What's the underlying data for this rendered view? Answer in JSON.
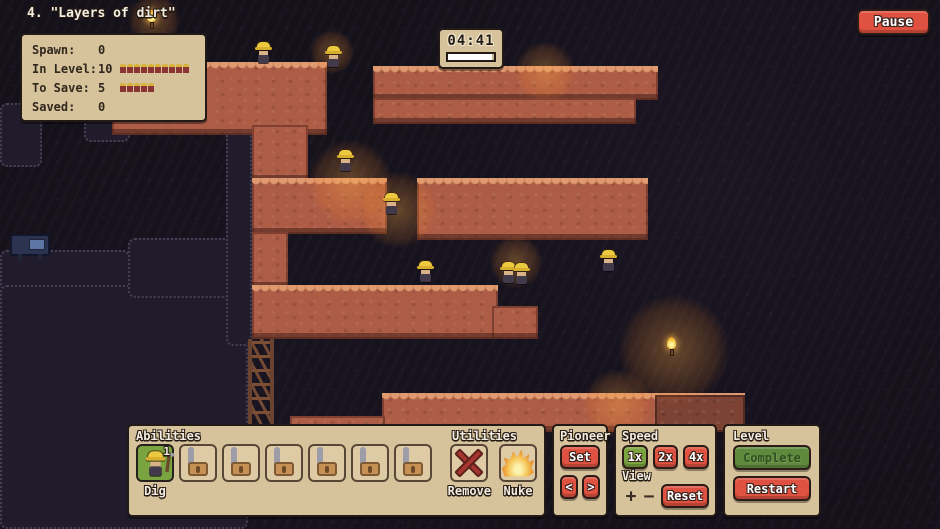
{
  "header": {
    "level_title": "4. \"Layers of dirt\"",
    "pause_label": "Pause"
  },
  "stats_panel": {
    "rows": [
      {
        "label": "Spawn:",
        "value": "0",
        "icons": 0
      },
      {
        "label": "In Level:",
        "value": "10",
        "icons": 10
      },
      {
        "label": "To Save:",
        "value": "5",
        "icons": 5
      },
      {
        "label": "Saved:",
        "value": "0",
        "icons": 0
      }
    ]
  },
  "timer": {
    "time": "04:41",
    "progress_pct": 96
  },
  "abilities_panel": {
    "title": "Abilities",
    "dig": {
      "label": "Dig",
      "count": "1"
    },
    "locked_slots": 6,
    "utilities": {
      "title": "Utilities",
      "items": [
        {
          "label": "Remove"
        },
        {
          "label": "Nuke"
        }
      ]
    }
  },
  "pioneer_panel": {
    "title": "Pioneer",
    "set_label": "Set",
    "prev_label": "<",
    "next_label": ">"
  },
  "speed_panel": {
    "title": "Speed",
    "speeds": [
      {
        "label": "1x",
        "active": true
      },
      {
        "label": "2x",
        "active": false
      },
      {
        "label": "4x",
        "active": false
      }
    ],
    "view_label": "View",
    "zoom_in_label": "+",
    "zoom_out_label": "−",
    "reset_label": "Reset"
  },
  "level_panel": {
    "title": "Level",
    "complete_label": "Complete",
    "restart_label": "Restart"
  },
  "colors": {
    "accent_red": "#df5140",
    "accent_green": "#7aa43f",
    "panel_beige": "#d7c39b",
    "dirt": "#ad5c45",
    "dirt_highlight": "#e09a70",
    "background": "#15111b"
  },
  "playfield": {
    "platforms": [
      {
        "x": 112,
        "y": 62,
        "w": 215,
        "h": 73
      },
      {
        "x": 373,
        "y": 66,
        "w": 285,
        "h": 34
      },
      {
        "x": 373,
        "y": 98,
        "w": 263,
        "h": 26,
        "flat": true
      },
      {
        "x": 252,
        "y": 125,
        "w": 56,
        "h": 56,
        "flat": true
      },
      {
        "x": 252,
        "y": 178,
        "w": 135,
        "h": 56
      },
      {
        "x": 417,
        "y": 178,
        "w": 231,
        "h": 62
      },
      {
        "x": 252,
        "y": 232,
        "w": 36,
        "h": 56,
        "flat": true
      },
      {
        "x": 252,
        "y": 285,
        "w": 246,
        "h": 54
      },
      {
        "x": 492,
        "y": 306,
        "w": 46,
        "h": 33,
        "flat": true
      },
      {
        "x": 382,
        "y": 393,
        "w": 363,
        "h": 39
      },
      {
        "x": 655,
        "y": 395,
        "w": 90,
        "h": 37,
        "flat": true,
        "dim": true
      },
      {
        "x": 290,
        "y": 416,
        "w": 95,
        "h": 14,
        "flat": true
      }
    ],
    "rocks": [
      {
        "x": 0,
        "y": 103,
        "w": 42,
        "h": 64
      },
      {
        "x": 84,
        "y": 106,
        "w": 46,
        "h": 36
      },
      {
        "x": 0,
        "y": 250,
        "w": 130,
        "h": 42
      },
      {
        "x": 0,
        "y": 285,
        "w": 248,
        "h": 244
      },
      {
        "x": 128,
        "y": 238,
        "w": 120,
        "h": 60
      },
      {
        "x": 226,
        "y": 118,
        "w": 26,
        "h": 228
      }
    ],
    "glows": [
      {
        "x": 350,
        "y": 182,
        "r": 42
      },
      {
        "x": 398,
        "y": 210,
        "r": 38
      },
      {
        "x": 154,
        "y": 20,
        "r": 26
      },
      {
        "x": 674,
        "y": 350,
        "r": 55
      },
      {
        "x": 545,
        "y": 72,
        "r": 30
      },
      {
        "x": 618,
        "y": 404,
        "r": 34
      },
      {
        "x": 516,
        "y": 262,
        "r": 26
      },
      {
        "x": 332,
        "y": 52,
        "r": 22
      }
    ],
    "torches": [
      {
        "x": 147,
        "y": 10
      },
      {
        "x": 667,
        "y": 337
      }
    ],
    "machine": {
      "x": 10,
      "y": 234,
      "w": 40,
      "h": 22
    },
    "truss": {
      "x": 248,
      "y": 339,
      "w": 26,
      "h": 86
    },
    "miners": [
      {
        "x": 255,
        "y": 42
      },
      {
        "x": 325,
        "y": 46
      },
      {
        "x": 337,
        "y": 150
      },
      {
        "x": 383,
        "y": 193
      },
      {
        "x": 417,
        "y": 261
      },
      {
        "x": 500,
        "y": 262
      },
      {
        "x": 513,
        "y": 263
      },
      {
        "x": 600,
        "y": 250
      }
    ]
  }
}
